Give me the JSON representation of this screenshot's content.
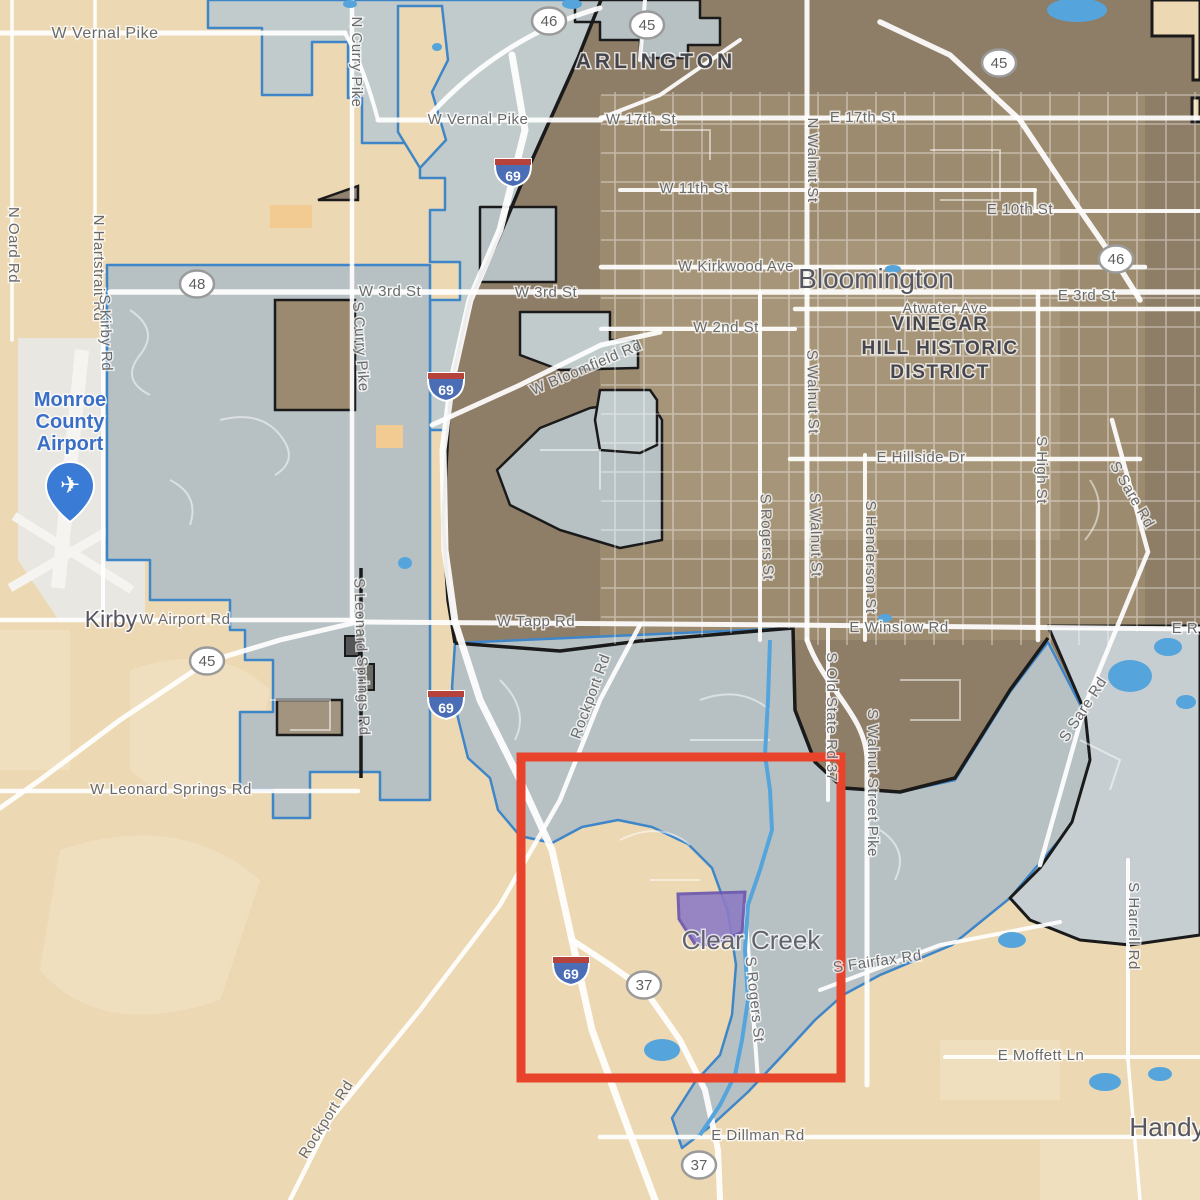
{
  "map": {
    "region": "Bloomington Indiana annexation map",
    "colors": {
      "bg_beige": "#ecd8b3",
      "beige_light": "#f3e4c6",
      "urban_dark": "#8f7e67",
      "urban_mid": "#a29173",
      "urban_light": "#ad9e80",
      "annex_fill": "#b7c1c4",
      "annex_light": "#c2cbcb",
      "se_annex_fill": "#c6ced1",
      "outline_blue": "#3f86c8",
      "outline_black": "#1a1a1a",
      "road_white": "#ffffff",
      "water_blue": "#55a5dc",
      "airport_gray": "#e9e7e2",
      "runway_white": "#f6f4f0",
      "orange_patch": "#f2cb92",
      "purple_fill": "#8d7cc5",
      "purple_stroke": "#6a55ae",
      "highlight_red": "#e8432b",
      "road_label_gray": "#6a6a6a",
      "place_label_gray": "#565660",
      "district_label_gray": "#46464e",
      "poi_blue": "#3a6fc8",
      "shield_fill": "#ffffff",
      "shield_border": "#9a9a9a",
      "shield_text": "#5f5f5f",
      "interstate_blue": "#4a6db5",
      "interstate_red": "#b5433c"
    },
    "place_labels": [
      {
        "text": "ARLINGTON",
        "x": 656,
        "y": 68,
        "size": 21,
        "weight": "bold",
        "ls": 4,
        "color": "#44444c"
      },
      {
        "text": "Bloomington",
        "x": 876,
        "y": 288,
        "size": 28,
        "weight": "normal",
        "ls": 0,
        "color": "#565660"
      },
      {
        "text": "Kirby",
        "x": 111,
        "y": 627,
        "size": 23,
        "weight": "normal",
        "ls": 0,
        "color": "#565660"
      },
      {
        "text": "Clear Creek",
        "x": 751,
        "y": 949,
        "size": 26,
        "weight": "normal",
        "ls": 0,
        "color": "#63636d"
      },
      {
        "text": "Handy",
        "x": 1167,
        "y": 1136,
        "size": 26,
        "weight": "normal",
        "ls": 0,
        "color": "#565660"
      }
    ],
    "district_label": {
      "lines": [
        "VINEGAR",
        "HILL HISTORIC",
        "DISTRICT"
      ],
      "x": 940,
      "y": 330,
      "line_h": 24,
      "size": 19,
      "ls": 1.5,
      "color": "#46464e"
    },
    "airport_poi": {
      "lines": [
        "Monroe",
        "County",
        "Airport"
      ],
      "x": 70,
      "y": 406,
      "line_h": 22,
      "size": 20,
      "color": "#3a6fc8",
      "pin_x": 70,
      "pin_y": 466
    },
    "road_labels": [
      {
        "text": "W Vernal Pike",
        "x": 105,
        "y": 38,
        "rot": 0,
        "size": 16
      },
      {
        "text": "W Vernal Pike",
        "x": 478,
        "y": 124,
        "rot": 0,
        "size": 15
      },
      {
        "text": "W 17th St",
        "x": 641,
        "y": 124,
        "rot": 0,
        "size": 15
      },
      {
        "text": "E 17th St",
        "x": 863,
        "y": 122,
        "rot": 0,
        "size": 15
      },
      {
        "text": "W 11th St",
        "x": 694,
        "y": 193,
        "rot": 0,
        "size": 15
      },
      {
        "text": "E 10th St",
        "x": 1020,
        "y": 214,
        "rot": 0,
        "size": 15
      },
      {
        "text": "W Kirkwood Ave",
        "x": 736,
        "y": 271,
        "rot": 0,
        "size": 15
      },
      {
        "text": "Atwater Ave",
        "x": 945,
        "y": 313,
        "rot": 0,
        "size": 15
      },
      {
        "text": "W 3rd St",
        "x": 390,
        "y": 296,
        "rot": 0,
        "size": 15
      },
      {
        "text": "W 3rd St",
        "x": 546,
        "y": 297,
        "rot": 0,
        "size": 15
      },
      {
        "text": "E 3rd St",
        "x": 1087,
        "y": 300,
        "rot": 0,
        "size": 15
      },
      {
        "text": "W 2nd St",
        "x": 726,
        "y": 332,
        "rot": 0,
        "size": 15
      },
      {
        "text": "E Hillside Dr",
        "x": 921,
        "y": 462,
        "rot": 0,
        "size": 15
      },
      {
        "text": "W Tapp Rd",
        "x": 536,
        "y": 626,
        "rot": 0,
        "size": 15
      },
      {
        "text": "E Winslow Rd",
        "x": 899,
        "y": 632,
        "rot": 0,
        "size": 15
      },
      {
        "text": "W Airport Rd",
        "x": 185,
        "y": 624,
        "rot": 0,
        "size": 15
      },
      {
        "text": "W Leonard Springs Rd",
        "x": 171,
        "y": 794,
        "rot": 0,
        "size": 15
      },
      {
        "text": "E Moffett Ln",
        "x": 1041,
        "y": 1060,
        "rot": 0,
        "size": 15
      },
      {
        "text": "E Dillman Rd",
        "x": 758,
        "y": 1140,
        "rot": 0,
        "size": 15
      },
      {
        "text": "E R",
        "x": 1185,
        "y": 633,
        "rot": 0,
        "size": 15
      },
      {
        "text": "W Bloomfield Rd",
        "x": 588,
        "y": 372,
        "rot": -23,
        "size": 15
      },
      {
        "text": "S Fairfax Rd",
        "x": 878,
        "y": 966,
        "rot": -8,
        "size": 15
      },
      {
        "text": "Rockport Rd",
        "x": 595,
        "y": 698,
        "rot": -70,
        "size": 15
      },
      {
        "text": "Rockport Rd",
        "x": 330,
        "y": 1122,
        "rot": -58,
        "size": 15
      },
      {
        "text": "N Curry Pike",
        "x": 352,
        "y": 62,
        "rot": 90,
        "size": 15
      },
      {
        "text": "N Oard Rd",
        "x": 9,
        "y": 245,
        "rot": 90,
        "size": 15
      },
      {
        "text": "N Hartstrait Rd",
        "x": 94,
        "y": 268,
        "rot": 90,
        "size": 15
      },
      {
        "text": "S Kirby Rd",
        "x": 101,
        "y": 333,
        "rot": 88,
        "size": 15
      },
      {
        "text": "S Curry Pike",
        "x": 356,
        "y": 347,
        "rot": 86,
        "size": 15
      },
      {
        "text": "N Walnut St",
        "x": 808,
        "y": 160,
        "rot": 90,
        "size": 15
      },
      {
        "text": "S Walnut St",
        "x": 808,
        "y": 392,
        "rot": 89,
        "size": 15
      },
      {
        "text": "S Walnut St",
        "x": 811,
        "y": 535,
        "rot": 89,
        "size": 15
      },
      {
        "text": "S Rogers St",
        "x": 762,
        "y": 537,
        "rot": 88,
        "size": 15
      },
      {
        "text": "S Henderson St",
        "x": 866,
        "y": 557,
        "rot": 90,
        "size": 15
      },
      {
        "text": "S High St",
        "x": 1037,
        "y": 470,
        "rot": 90,
        "size": 15
      },
      {
        "text": "S Sare Rd",
        "x": 1128,
        "y": 497,
        "rot": 60,
        "size": 15
      },
      {
        "text": "S Sare Rd",
        "x": 1087,
        "y": 712,
        "rot": -57,
        "size": 15
      },
      {
        "text": "S Leonard Springs Rd",
        "x": 357,
        "y": 657,
        "rot": 88,
        "size": 15
      },
      {
        "text": "S Old State Rd 37",
        "x": 827,
        "y": 717,
        "rot": 90,
        "size": 15
      },
      {
        "text": "S Walnut Street Pike",
        "x": 868,
        "y": 783,
        "rot": 90,
        "size": 15
      },
      {
        "text": "S Rogers St",
        "x": 750,
        "y": 1000,
        "rot": 84,
        "size": 15
      },
      {
        "text": "S Harrell Rd",
        "x": 1129,
        "y": 926,
        "rot": 90,
        "size": 15
      }
    ],
    "route_shields": [
      {
        "label": "46",
        "x": 549,
        "y": 21
      },
      {
        "label": "45",
        "x": 647,
        "y": 25
      },
      {
        "label": "45",
        "x": 999,
        "y": 63
      },
      {
        "label": "46",
        "x": 1116,
        "y": 259
      },
      {
        "label": "48",
        "x": 197,
        "y": 284
      },
      {
        "label": "45",
        "x": 207,
        "y": 661
      },
      {
        "label": "37",
        "x": 644,
        "y": 985
      },
      {
        "label": "37",
        "x": 699,
        "y": 1165
      }
    ],
    "interstate_shields": [
      {
        "label": "69",
        "x": 513,
        "y": 172
      },
      {
        "label": "69",
        "x": 446,
        "y": 386
      },
      {
        "label": "69",
        "x": 446,
        "y": 704
      },
      {
        "label": "69",
        "x": 571,
        "y": 970
      }
    ],
    "annotations": {
      "highlight_rect": {
        "x": 521,
        "y": 757,
        "w": 320,
        "h": 321,
        "stroke_w": 9
      },
      "purple_parcel_points": "678,894 745,892 742,932 712,945 695,944 679,919"
    }
  }
}
